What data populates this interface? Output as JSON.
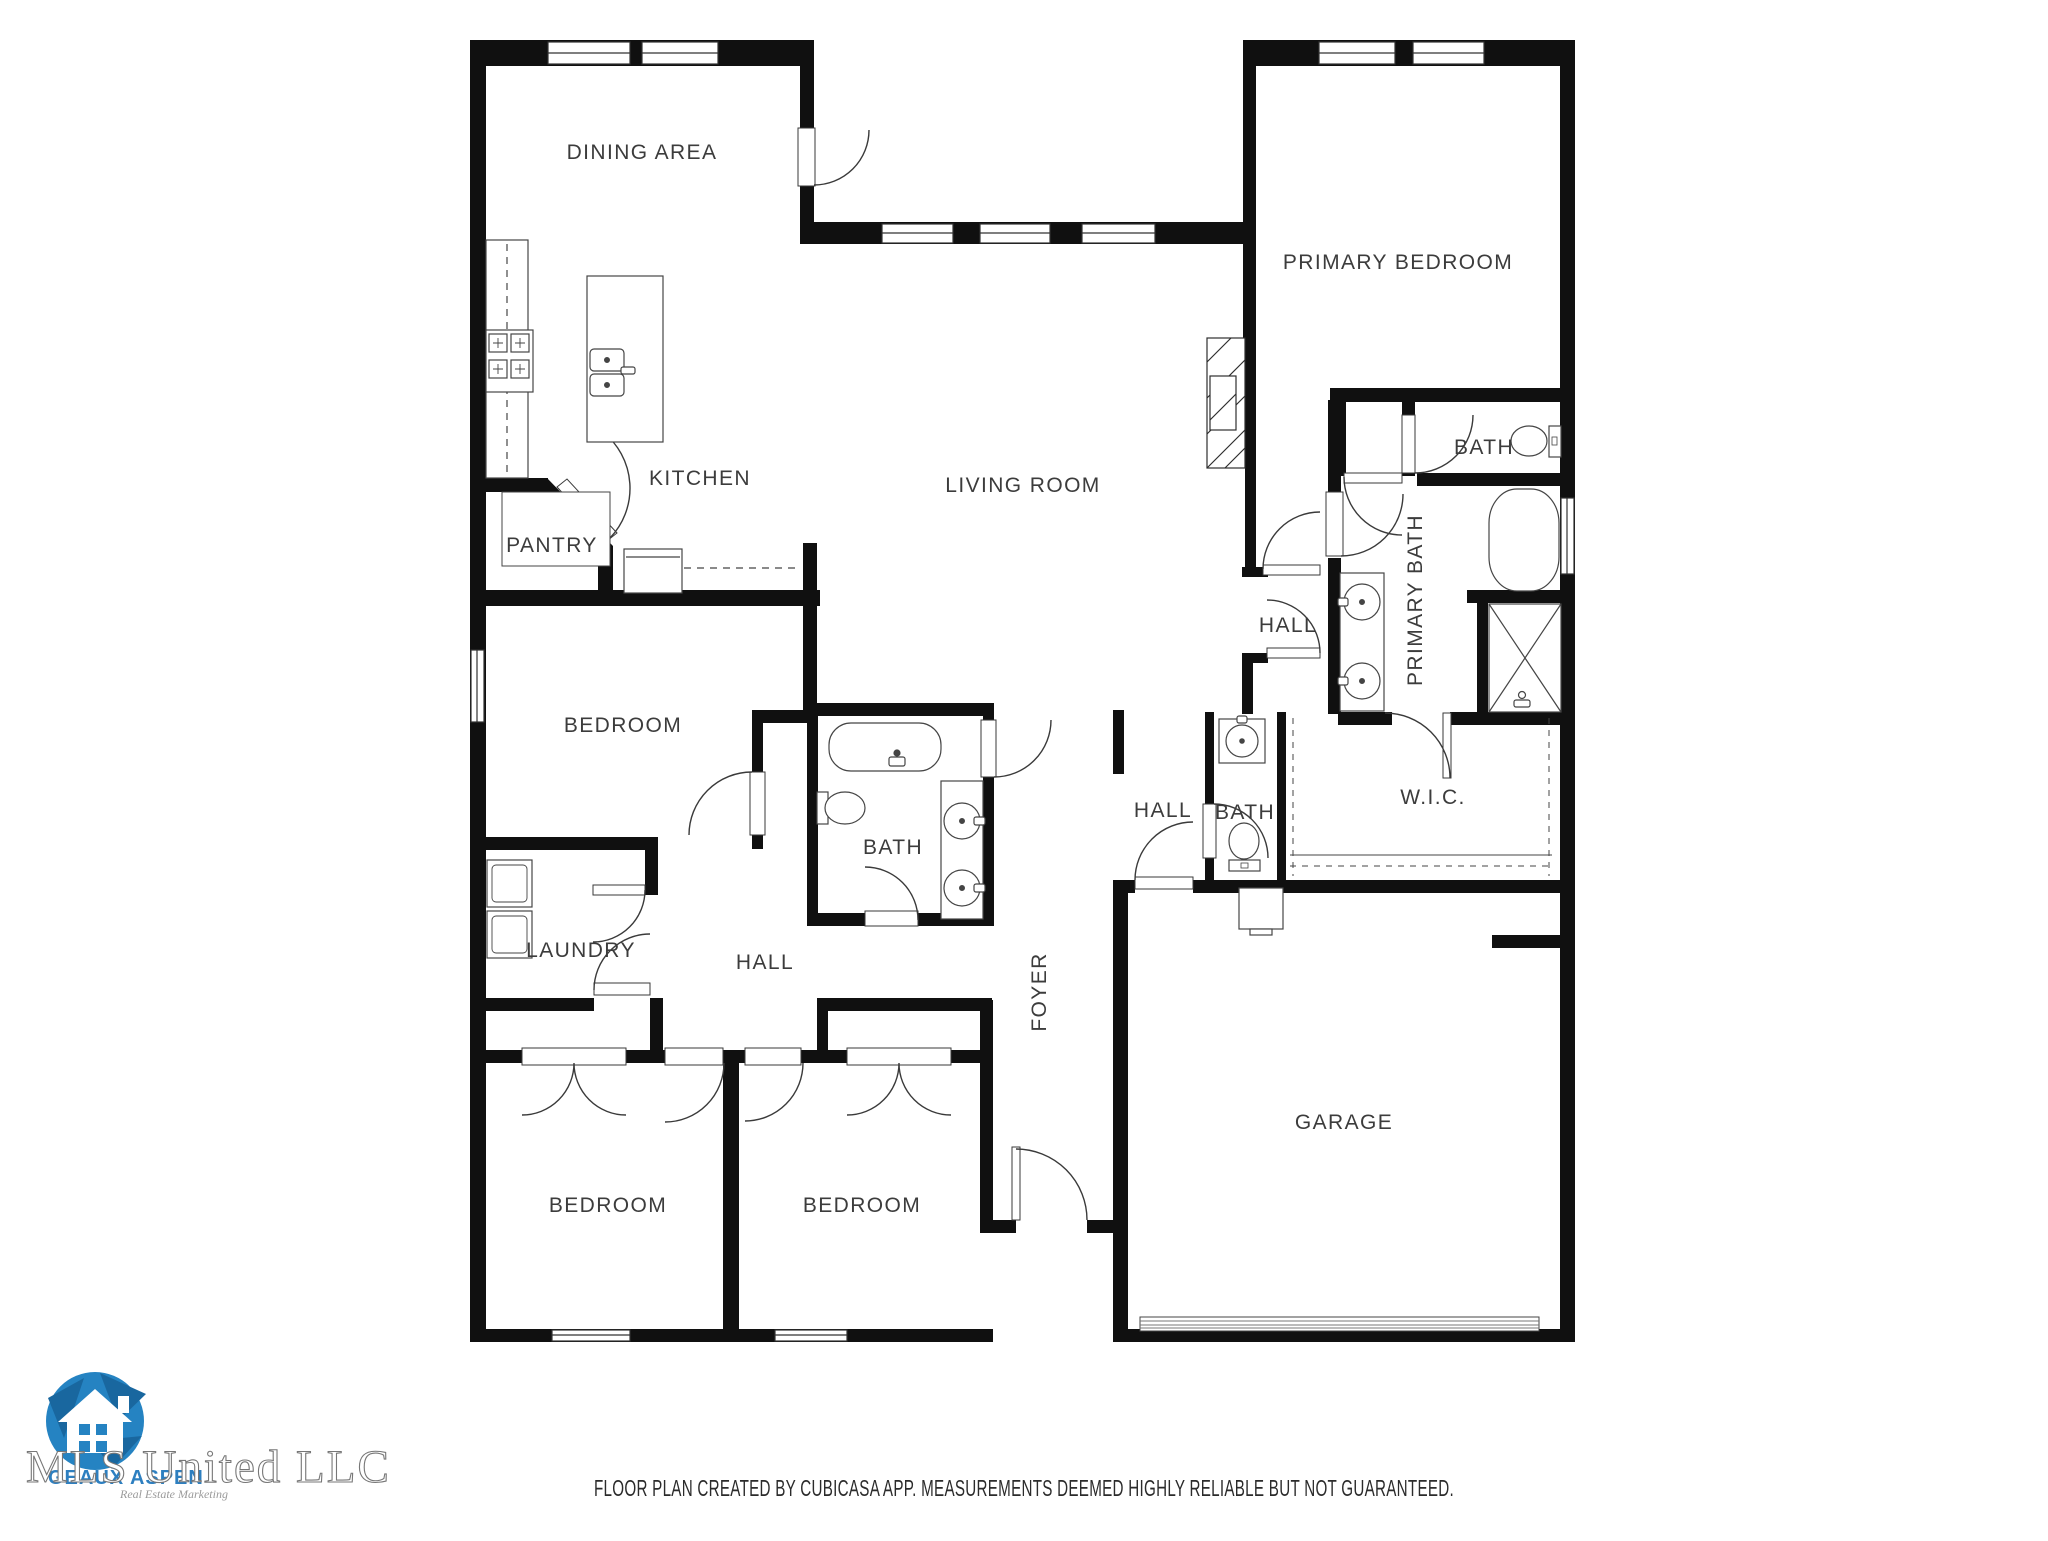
{
  "rooms": [
    {
      "label": "DINING AREA"
    },
    {
      "label": "PRIMARY BEDROOM"
    },
    {
      "label": "KITCHEN"
    },
    {
      "label": "LIVING ROOM"
    },
    {
      "label": "PANTRY"
    },
    {
      "label": "BATH"
    },
    {
      "label": "HALL"
    },
    {
      "label": "PRIMARY BATH"
    },
    {
      "label": "BEDROOM"
    },
    {
      "label": "BATH"
    },
    {
      "label": "LAUNDRY"
    },
    {
      "label": "HALL"
    },
    {
      "label": "HALL"
    },
    {
      "label": "BATH"
    },
    {
      "label": "W.I.C."
    },
    {
      "label": "FOYER"
    },
    {
      "label": "BEDROOM"
    },
    {
      "label": "BEDROOM"
    },
    {
      "label": "GARAGE"
    }
  ],
  "footer": {
    "disclaimer": "FLOOR PLAN CREATED BY CUBICASA APP. MEASUREMENTS DEEMED HIGHLY RELIABLE BUT NOT GUARANTEED."
  },
  "watermark": {
    "title": "MLS United LLC",
    "brand": "GEAUX ASPEN",
    "tagline": "Real Estate Marketing"
  },
  "colors": {
    "wall": "#101010",
    "fixture_stroke": "#454545",
    "label": "#3c3c3c",
    "logo_blue": "#2583c2",
    "logo_blue_dark": "#19679f"
  }
}
